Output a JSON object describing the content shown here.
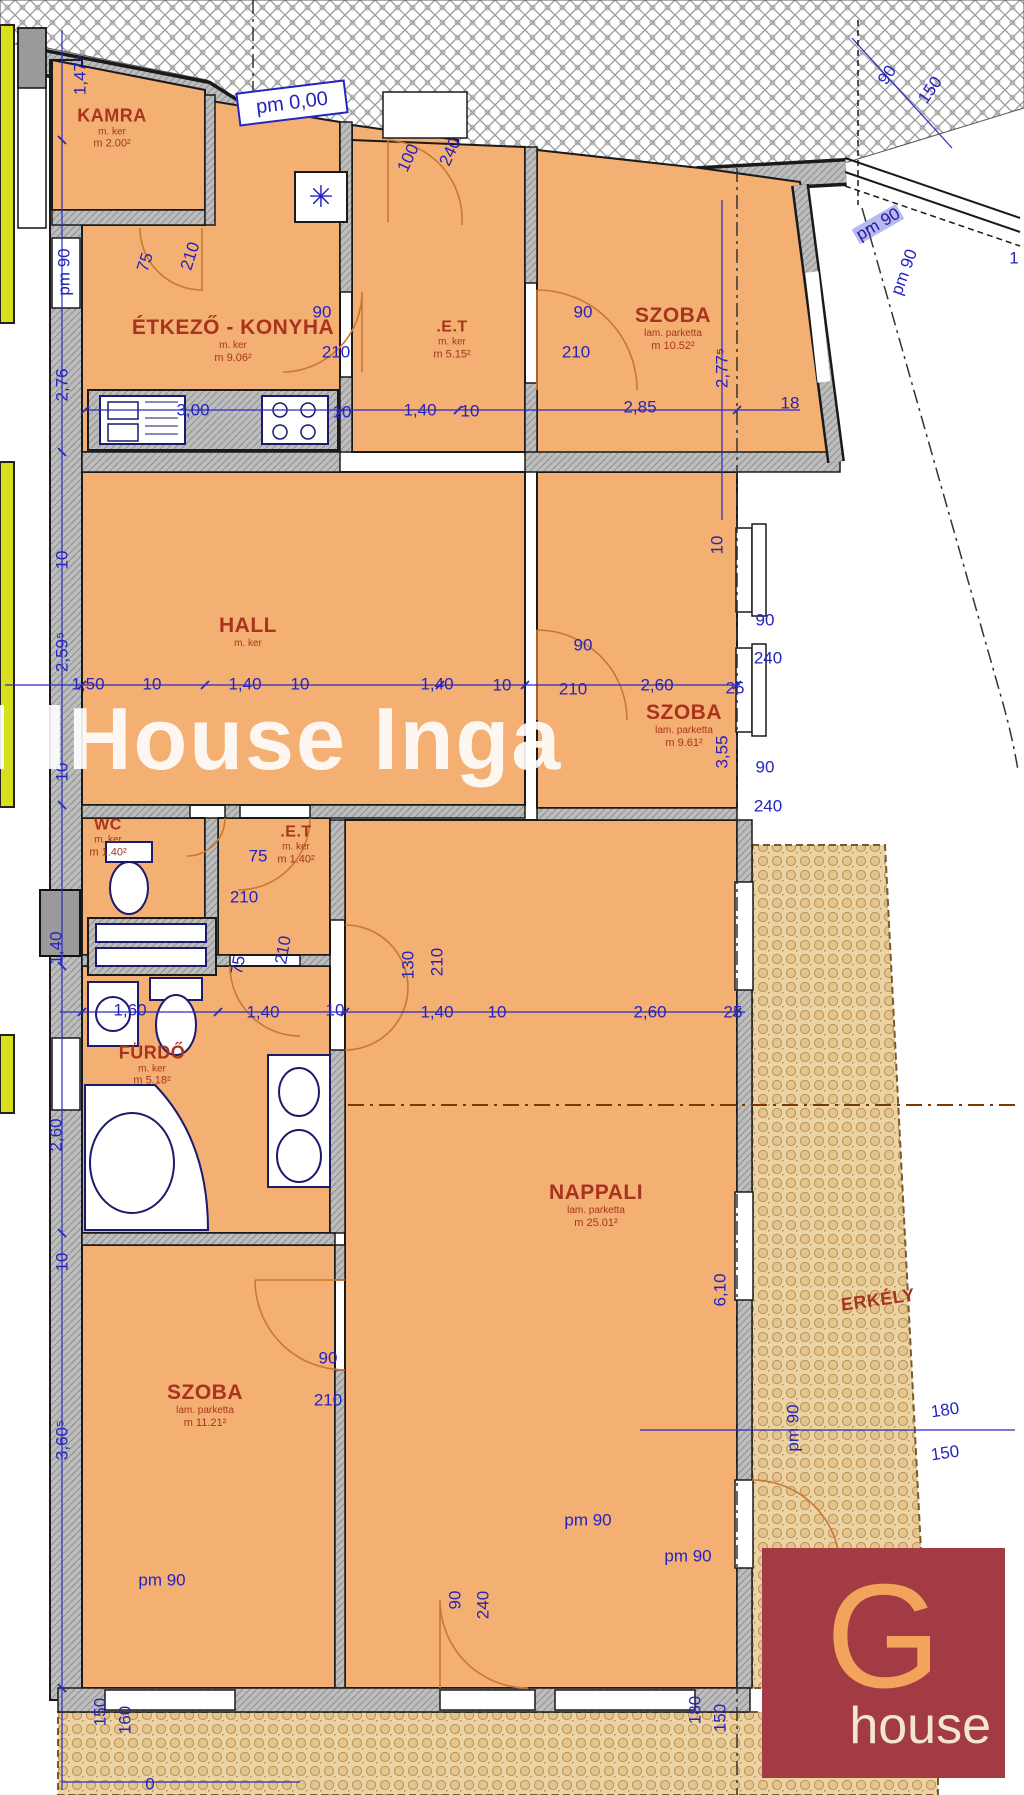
{
  "plan": {
    "watermark": "oldHouse Inga",
    "level_note": "pm 0,00",
    "boiler_symbol": "✳",
    "colors": {
      "room_fill": "#F4AF72",
      "balcony_fill": "#EBD3A3",
      "dim_blue": "#2424BE",
      "room_text": "#A83420",
      "lime_strip": "#D8DF1F",
      "logo_bg": "#A23B44",
      "logo_g": "#F2A45C",
      "logo_word": "#F2E6CC"
    },
    "logo": {
      "initial": "G",
      "word": "house"
    },
    "rooms": [
      {
        "id": "kamra",
        "cls": "md",
        "name": "KAMRA",
        "floor": "m. ker",
        "area": "m 2.00²",
        "x": 112,
        "y": 128
      },
      {
        "id": "etkezo-konyha",
        "cls": "",
        "name": "ÉTKEZŐ - KONYHA",
        "floor": "m. ker",
        "area": "m 9.06²",
        "x": 233,
        "y": 340
      },
      {
        "id": "et-felso",
        "cls": "sm",
        "name": ".E.T",
        "floor": "m. ker",
        "area": "m 5.15²",
        "x": 452,
        "y": 340
      },
      {
        "id": "szoba-jobb-felso",
        "cls": "",
        "name": "SZOBA",
        "floor": "lam. parketta",
        "area": "m 10.52²",
        "x": 673,
        "y": 328
      },
      {
        "id": "hall",
        "cls": "",
        "name": "HALL",
        "floor": "m. ker",
        "area": "",
        "x": 248,
        "y": 632
      },
      {
        "id": "szoba-kozep",
        "cls": "",
        "name": "SZOBA",
        "floor": "lam. parketta",
        "area": "m 9.61²",
        "x": 684,
        "y": 725
      },
      {
        "id": "wc",
        "cls": "sm",
        "name": "WC",
        "floor": "m. ker",
        "area": "m 1.40²",
        "x": 108,
        "y": 838
      },
      {
        "id": "et-kozep",
        "cls": "sm",
        "name": ".E.T",
        "floor": "m. ker",
        "area": "m 1.40²",
        "x": 296,
        "y": 845
      },
      {
        "id": "furdo",
        "cls": "md",
        "name": "FÜRDŐ",
        "floor": "m. ker",
        "area": "m 5.18²",
        "x": 152,
        "y": 1065
      },
      {
        "id": "nappali",
        "cls": "",
        "name": "NAPPALI",
        "floor": "lam. parketta",
        "area": "m 25.01²",
        "x": 596,
        "y": 1205
      },
      {
        "id": "szoba-also",
        "cls": "",
        "name": "SZOBA",
        "floor": "lam. parketta",
        "area": "m 11.21²",
        "x": 205,
        "y": 1405
      },
      {
        "id": "erkely",
        "cls": "md",
        "name": "ERKÉLY",
        "floor": "",
        "area": "",
        "x": 878,
        "y": 1300,
        "rot": -8
      }
    ],
    "dimensions": [
      {
        "t": "1,47⁵",
        "x": 80,
        "y": 75,
        "rot": -90
      },
      {
        "t": "pm 90",
        "x": 64,
        "y": 272,
        "rot": -90
      },
      {
        "t": "2,76",
        "x": 62,
        "y": 385,
        "rot": -90
      },
      {
        "t": "10",
        "x": 62,
        "y": 560,
        "rot": -90
      },
      {
        "t": "2,59⁵",
        "x": 62,
        "y": 652,
        "rot": -90
      },
      {
        "t": "10",
        "x": 62,
        "y": 772,
        "rot": -90
      },
      {
        "t": "1,40",
        "x": 56,
        "y": 948,
        "rot": -90
      },
      {
        "t": "2,60",
        "x": 56,
        "y": 1135,
        "rot": -90
      },
      {
        "t": "10",
        "x": 62,
        "y": 1262,
        "rot": -90
      },
      {
        "t": "3,60⁵",
        "x": 62,
        "y": 1440,
        "rot": -90
      },
      {
        "t": "0",
        "x": 150,
        "y": 1784
      },
      {
        "t": "75",
        "x": 145,
        "y": 262,
        "rot": -72
      },
      {
        "t": "210",
        "x": 190,
        "y": 256,
        "rot": -72
      },
      {
        "t": "90",
        "x": 322,
        "y": 312
      },
      {
        "t": "210",
        "x": 336,
        "y": 352
      },
      {
        "t": "100",
        "x": 408,
        "y": 158,
        "rot": -65
      },
      {
        "t": "240",
        "x": 450,
        "y": 152,
        "rot": -65
      },
      {
        "t": "3,00",
        "x": 193,
        "y": 410
      },
      {
        "t": "10",
        "x": 342,
        "y": 412
      },
      {
        "t": "1,40",
        "x": 420,
        "y": 410
      },
      {
        "t": "10",
        "x": 470,
        "y": 411
      },
      {
        "t": "2,85",
        "x": 640,
        "y": 407
      },
      {
        "t": "18",
        "x": 790,
        "y": 403
      },
      {
        "t": "90",
        "x": 583,
        "y": 312
      },
      {
        "t": "210",
        "x": 576,
        "y": 352
      },
      {
        "t": "2,77⁵",
        "x": 722,
        "y": 368,
        "rot": -90
      },
      {
        "t": "90",
        "x": 887,
        "y": 75,
        "rot": -55
      },
      {
        "t": "150",
        "x": 930,
        "y": 90,
        "rot": -55
      },
      {
        "t": "pm 90",
        "x": 878,
        "y": 224,
        "rot": -30,
        "hl": true
      },
      {
        "t": "pm 90",
        "x": 904,
        "y": 272,
        "rot": -70
      },
      {
        "t": "1",
        "x": 1014,
        "y": 258
      },
      {
        "t": "1,50",
        "x": 88,
        "y": 684
      },
      {
        "t": "10",
        "x": 152,
        "y": 684
      },
      {
        "t": "1,40",
        "x": 245,
        "y": 684
      },
      {
        "t": "10",
        "x": 300,
        "y": 684
      },
      {
        "t": "1,40",
        "x": 437,
        "y": 684
      },
      {
        "t": "10",
        "x": 502,
        "y": 685
      },
      {
        "t": "90",
        "x": 583,
        "y": 645
      },
      {
        "t": "210",
        "x": 573,
        "y": 689
      },
      {
        "t": "2,60",
        "x": 657,
        "y": 685
      },
      {
        "t": "25",
        "x": 735,
        "y": 688
      },
      {
        "t": "10",
        "x": 717,
        "y": 545,
        "rot": -90
      },
      {
        "t": "90",
        "x": 765,
        "y": 620
      },
      {
        "t": "240",
        "x": 768,
        "y": 658
      },
      {
        "t": "90",
        "x": 765,
        "y": 767
      },
      {
        "t": "240",
        "x": 768,
        "y": 806
      },
      {
        "t": "3,55",
        "x": 722,
        "y": 752,
        "rot": -90
      },
      {
        "t": "75",
        "x": 258,
        "y": 856
      },
      {
        "t": "210",
        "x": 244,
        "y": 897
      },
      {
        "t": "1,60",
        "x": 130,
        "y": 1010
      },
      {
        "t": "1,40",
        "x": 263,
        "y": 1012
      },
      {
        "t": "10",
        "x": 335,
        "y": 1010
      },
      {
        "t": "1,40",
        "x": 437,
        "y": 1012
      },
      {
        "t": "10",
        "x": 497,
        "y": 1012
      },
      {
        "t": "2,60",
        "x": 650,
        "y": 1012
      },
      {
        "t": "25",
        "x": 733,
        "y": 1012
      },
      {
        "t": "75",
        "x": 238,
        "y": 965,
        "rot": -80
      },
      {
        "t": "210",
        "x": 283,
        "y": 950,
        "rot": -80
      },
      {
        "t": "130",
        "x": 408,
        "y": 965,
        "rot": -90
      },
      {
        "t": "210",
        "x": 437,
        "y": 962,
        "rot": -90
      },
      {
        "t": "6,10",
        "x": 720,
        "y": 1290,
        "rot": -90
      },
      {
        "t": "90",
        "x": 328,
        "y": 1358
      },
      {
        "t": "210",
        "x": 328,
        "y": 1400
      },
      {
        "t": "pm 90",
        "x": 793,
        "y": 1428,
        "rot": -90
      },
      {
        "t": "180",
        "x": 945,
        "y": 1410,
        "rot": -8
      },
      {
        "t": "150",
        "x": 945,
        "y": 1453,
        "rot": -8
      },
      {
        "t": "pm 90",
        "x": 688,
        "y": 1556
      },
      {
        "t": "pm 90",
        "x": 588,
        "y": 1520
      },
      {
        "t": "pm 90",
        "x": 162,
        "y": 1580
      },
      {
        "t": "90",
        "x": 455,
        "y": 1600,
        "rot": -90
      },
      {
        "t": "240",
        "x": 483,
        "y": 1605,
        "rot": -90
      },
      {
        "t": "180",
        "x": 695,
        "y": 1710,
        "rot": -90
      },
      {
        "t": "150",
        "x": 720,
        "y": 1718,
        "rot": -90
      },
      {
        "t": "150",
        "x": 100,
        "y": 1712,
        "rot": -90
      },
      {
        "t": "160",
        "x": 125,
        "y": 1720,
        "rot": -90
      }
    ]
  }
}
